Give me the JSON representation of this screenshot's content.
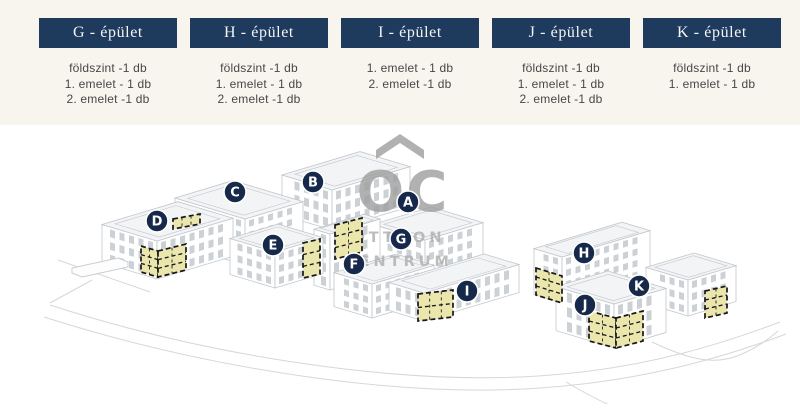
{
  "colors": {
    "band_background": "#f7f5ee",
    "button_navy": "#1e3a5c",
    "badge_navy": "#16294a",
    "highlight_yellow": "#eae6ac",
    "line_art_gray": "#c3c8cd",
    "watermark_gray": "#9e9e9e",
    "floor_text": "#474747"
  },
  "header": {
    "buildings": [
      {
        "name": "G - épület",
        "floors": [
          "földszint -1 db",
          "1. emelet - 1 db",
          "2. emelet -1 db"
        ]
      },
      {
        "name": "H - épület",
        "floors": [
          "földszint -1 db",
          "1. emelet - 1 db",
          "2. emelet -1 db"
        ]
      },
      {
        "name": "I - épület",
        "floors": [
          "1. emelet - 1 db",
          "2. emelet -1 db"
        ]
      },
      {
        "name": "J - épület",
        "floors": [
          "földszint -1 db",
          "1. emelet - 1 db",
          "2. emelet -1 db"
        ]
      },
      {
        "name": "K - épület",
        "floors": [
          "földszint -1 db",
          "1. emelet - 1 db"
        ]
      }
    ]
  },
  "map": {
    "badges": [
      "A",
      "B",
      "C",
      "D",
      "E",
      "F",
      "G",
      "H",
      "I",
      "J",
      "K"
    ],
    "watermark": {
      "monogram": "OC",
      "line1": "OTTHON",
      "line2": "CENTRUM"
    }
  }
}
